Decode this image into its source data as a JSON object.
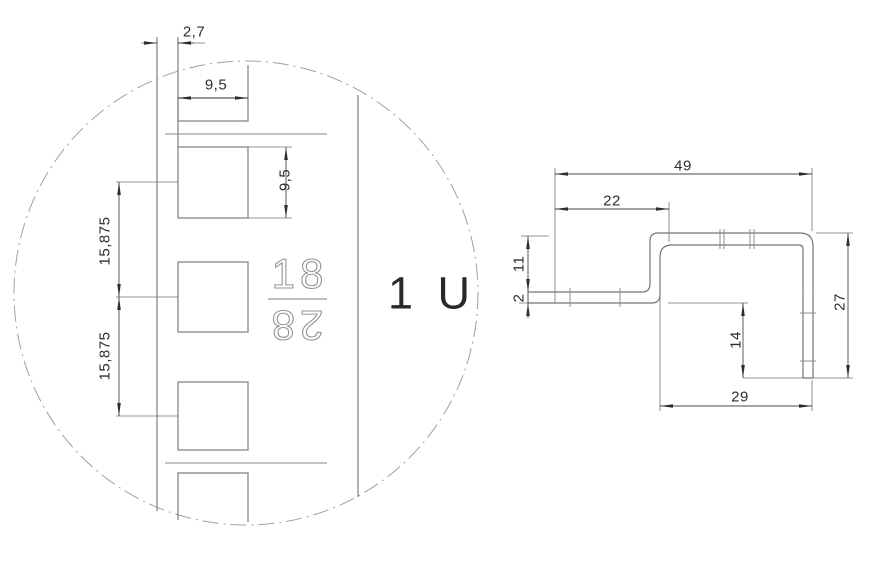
{
  "drawing": {
    "detail_view": {
      "rail_offset": "2,7",
      "hole_width": "9,5",
      "hole_height": "9,5",
      "hole_pitch_upper": "15,875",
      "hole_pitch_lower": "15,875",
      "unit_label": "1 U",
      "rail_marking_top": "18",
      "rail_marking_bottom": "28"
    },
    "profile_view": {
      "overall_width": "49",
      "flange_length": "22",
      "left_height": "11",
      "material_thickness": "2",
      "leg_depth": "14",
      "right_height": "27",
      "opening_width": "29"
    },
    "colors": {
      "geometry_line": "#7b8084",
      "profile_line": "#72767a",
      "dimension_line": "#44484c",
      "extension_line": "#6f7377",
      "centerline_circle": "#9ba1a6",
      "text": "#2c2e31",
      "stencil_stroke": "#90969b"
    }
  }
}
